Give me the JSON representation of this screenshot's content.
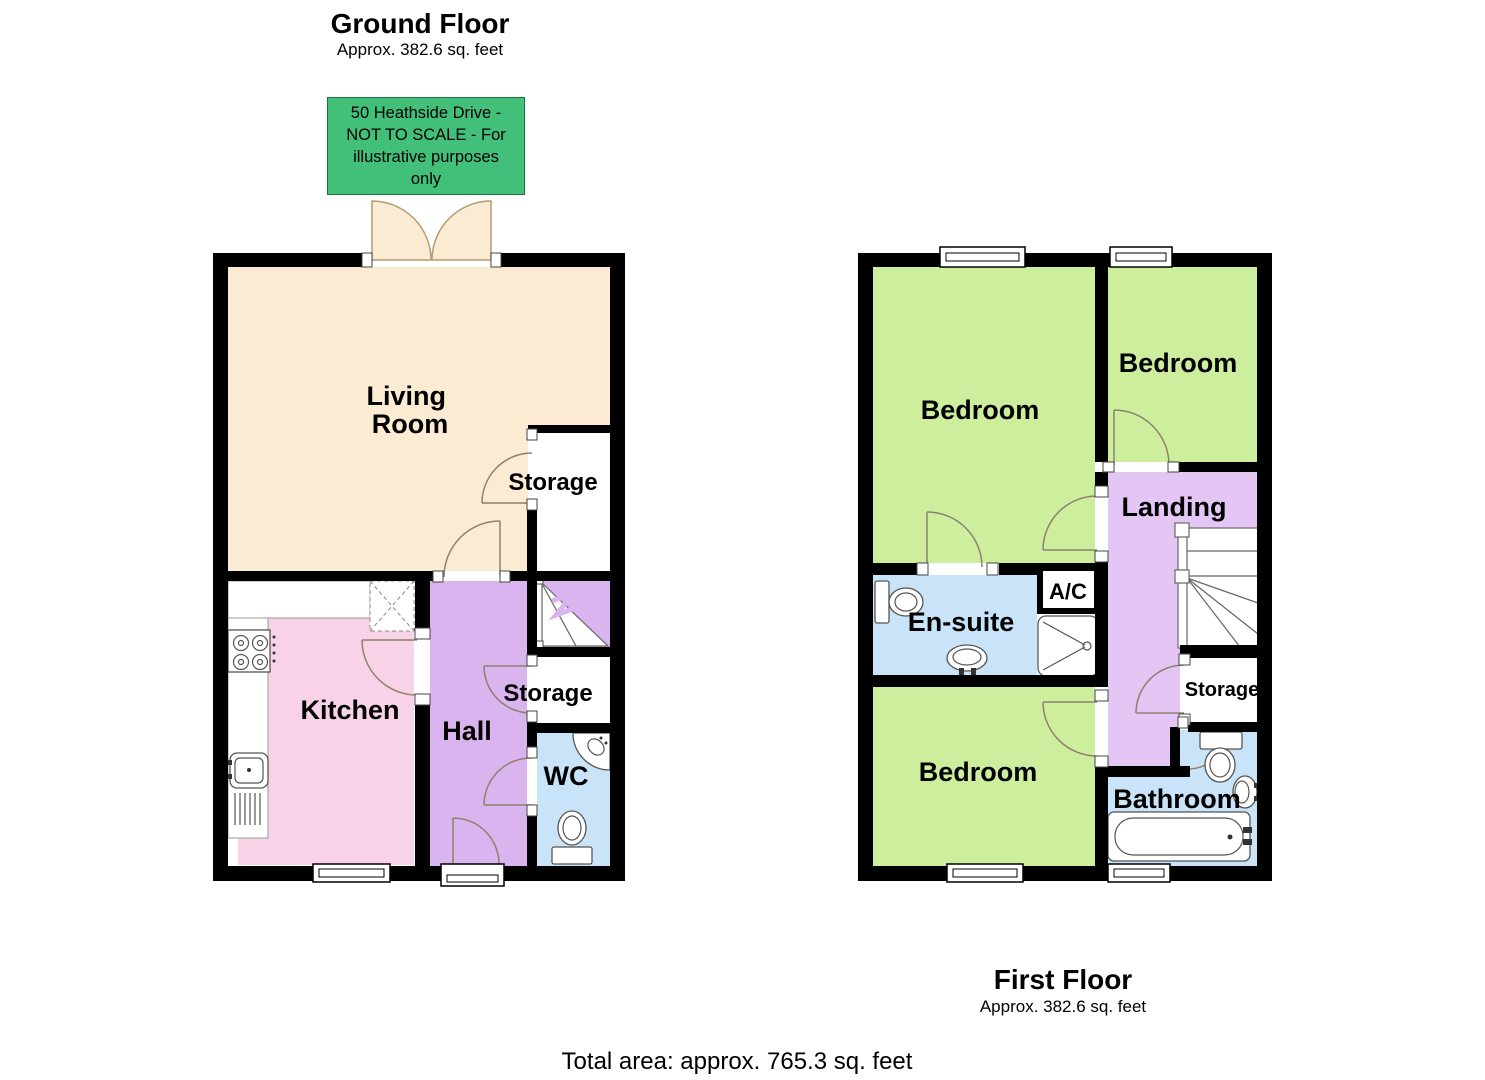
{
  "ground_floor": {
    "title": "Ground Floor",
    "area_note": "Approx. 382.6 sq. feet",
    "rooms": {
      "living_room_line1": "Living",
      "living_room_line2": "Room",
      "storage_upper": "Storage",
      "kitchen": "Kitchen",
      "hall": "Hall",
      "storage_lower": "Storage",
      "wc": "WC"
    }
  },
  "first_floor": {
    "title": "First Floor",
    "area_note": "Approx. 382.6 sq. feet",
    "rooms": {
      "bedroom_front": "Bedroom",
      "bedroom_rear": "Bedroom",
      "bedroom_third": "Bedroom",
      "landing": "Landing",
      "ensuite": "En-suite",
      "ac": "A/C",
      "storage": "Storage",
      "bathroom": "Bathroom"
    }
  },
  "scale_note": {
    "lines": [
      "50 Heathside Drive -",
      "NOT TO SCALE - For",
      "illustrative purposes",
      "only"
    ],
    "background": "#42C07A"
  },
  "total_area": "Total area: approx. 765.3 sq. feet",
  "colors": {
    "wall": "#000000",
    "living_room": "#FAEBD2",
    "kitchen": "#F8D3E7",
    "hall_stairs": "#D9B4EE",
    "landing": "#E3C6F3",
    "bedroom": "#CDEE9C",
    "bathroom_blue": "#C9E4F8",
    "note_box": "#42C07A"
  }
}
